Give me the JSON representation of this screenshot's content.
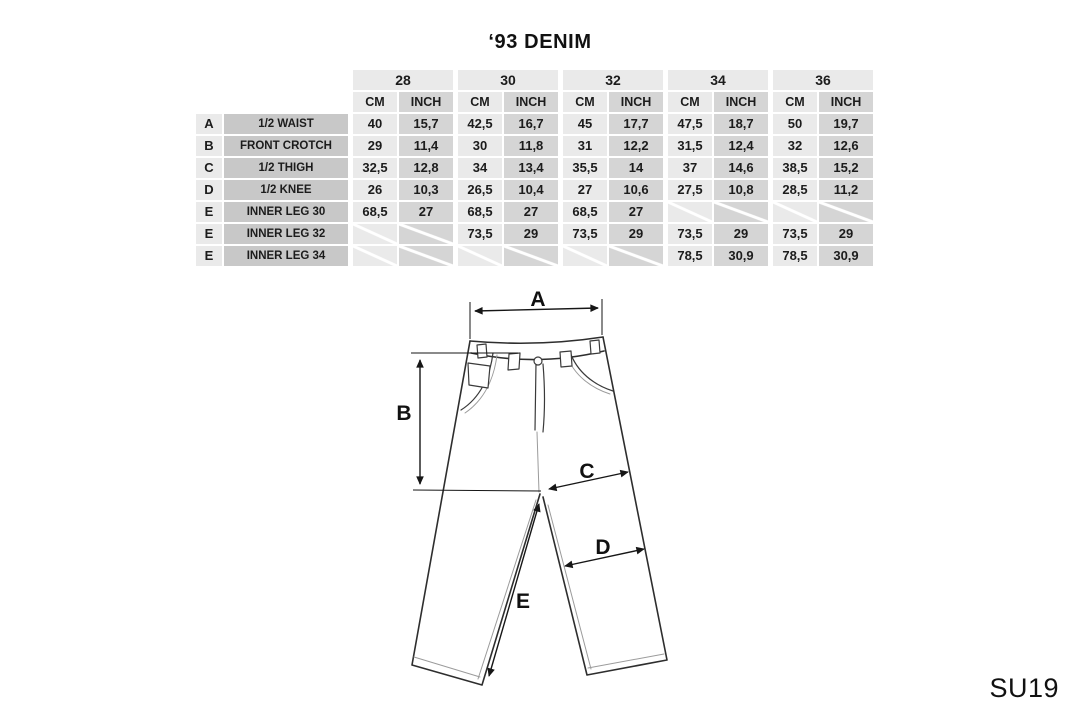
{
  "title": "‘93 DENIM",
  "season_code": "SU19",
  "size_chart": {
    "sizes": [
      "28",
      "30",
      "32",
      "34",
      "36"
    ],
    "unit_headers": [
      "CM",
      "INCH"
    ],
    "rows": [
      {
        "letter": "A",
        "label": "1/2 WAIST",
        "values": [
          "40",
          "15,7",
          "42,5",
          "16,7",
          "45",
          "17,7",
          "47,5",
          "18,7",
          "50",
          "19,7"
        ]
      },
      {
        "letter": "B",
        "label": "FRONT CROTCH",
        "values": [
          "29",
          "11,4",
          "30",
          "11,8",
          "31",
          "12,2",
          "31,5",
          "12,4",
          "32",
          "12,6"
        ]
      },
      {
        "letter": "C",
        "label": "1/2 THIGH",
        "values": [
          "32,5",
          "12,8",
          "34",
          "13,4",
          "35,5",
          "14",
          "37",
          "14,6",
          "38,5",
          "15,2"
        ]
      },
      {
        "letter": "D",
        "label": "1/2 KNEE",
        "values": [
          "26",
          "10,3",
          "26,5",
          "10,4",
          "27",
          "10,6",
          "27,5",
          "10,8",
          "28,5",
          "11,2"
        ]
      },
      {
        "letter": "E",
        "label": "INNER LEG 30",
        "values": [
          "68,5",
          "27",
          "68,5",
          "27",
          "68,5",
          "27",
          null,
          null,
          null,
          null
        ]
      },
      {
        "letter": "E",
        "label": "INNER LEG 32",
        "values": [
          null,
          null,
          "73,5",
          "29",
          "73,5",
          "29",
          "73,5",
          "29",
          "73,5",
          "29"
        ]
      },
      {
        "letter": "E",
        "label": "INNER LEG 34",
        "values": [
          null,
          null,
          null,
          null,
          null,
          null,
          "78,5",
          "30,9",
          "78,5",
          "30,9"
        ]
      }
    ]
  },
  "diagram": {
    "labels": {
      "waist": "A",
      "front_crotch": "B",
      "thigh": "C",
      "knee": "D",
      "inner_leg": "E"
    }
  },
  "colors": {
    "background": "#ffffff",
    "cell_light": "#eaeaea",
    "cell_dark": "#d5d5d5",
    "cell_label": "#c8c8c8",
    "line": "#2e2e2e",
    "text": "#1c1c1c"
  }
}
